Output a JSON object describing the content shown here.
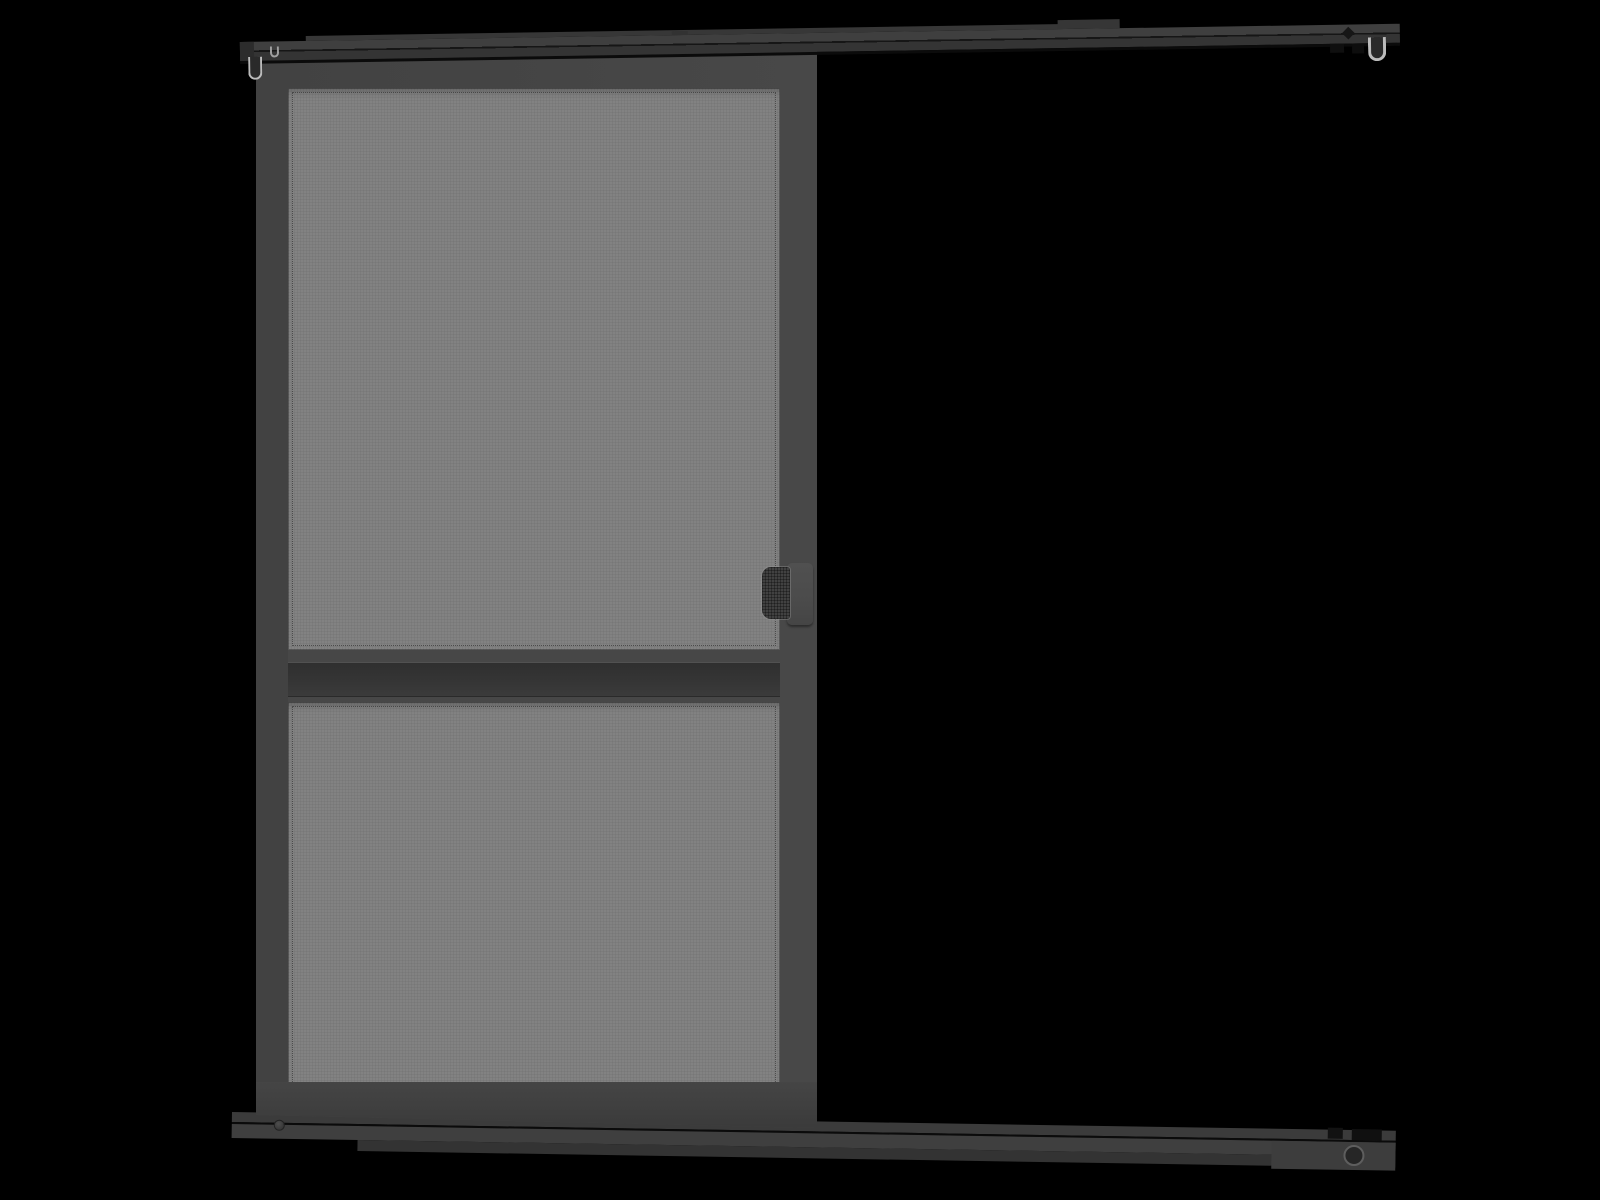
{
  "scene": {
    "type": "product-render",
    "subject": "sliding-screen-door",
    "visible_text": []
  },
  "palette": {
    "background": "#000000",
    "frame": "#454545",
    "frame_dark": "#3d3d3d",
    "mesh": "#828282",
    "mesh_dot": "#4a4a4a",
    "track_top": "#3d3d3d",
    "track_bottom": "#343434",
    "track_seam": "#0b0b0b",
    "track_endcap": "#2c2c2c",
    "btm_strip": "#3b3b3b",
    "btm_face": "#3f3f3f",
    "btm_lip": "#333333",
    "rail_flange": "#474747",
    "rail_recess_dark": "#2f2f2f",
    "rail_recess_light": "#3b3b3b",
    "handle_plate": "#4b4b4b",
    "handle_grip": "#414141",
    "hook_outline": "#bcbcbc",
    "hook_fill": "#2a2a2a",
    "roller_ring": "#5e5e5e",
    "roller_center": "#262626",
    "screw": "#4e4e4e"
  },
  "parts": {
    "top_track": "top hanging track",
    "top_track_left_hook": "left end hook",
    "top_track_right_hook": "right end hook",
    "door": "sliding screen door panel",
    "mesh_upper": "upper mesh panel",
    "mesh_lower": "lower mesh panel",
    "middle_rail": "horizontal middle rail",
    "handle": "door pull handle",
    "bottom_track": "bottom guide track",
    "bottom_roller": "bottom track roller"
  }
}
